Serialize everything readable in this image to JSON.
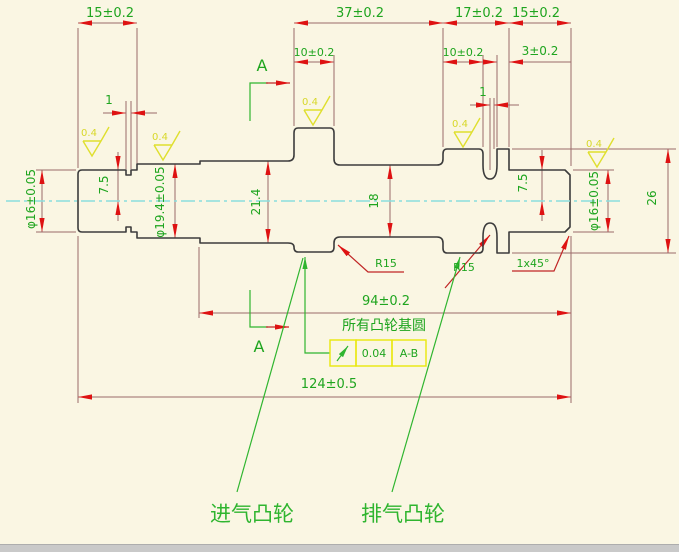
{
  "drawing_type": "camshaft engineering drawing",
  "colors": {
    "background": "#FAF6E3",
    "part_outline": "#3C3C3C",
    "centerline": "#8ADEDE",
    "dimension_line": "#9B6A6A",
    "arrow": "#DE1212",
    "dimension_text": "#1FA51F",
    "leader_line": "#C02525",
    "surface_finish_symbol": "#DFDF2E",
    "tolerance_frame_border": "#E8E80A",
    "cam_label_green": "#2FB52F"
  },
  "dimensions": {
    "top_row": [
      {
        "id": "left-end-length",
        "text": "15±0.2"
      },
      {
        "id": "intake-to-exhaust-span",
        "text": "37±0.2"
      },
      {
        "id": "exhaust-group-length",
        "text": "17±0.2"
      },
      {
        "id": "right-end-length",
        "text": "15±0.2"
      }
    ],
    "second_row": [
      {
        "id": "intake-cam-width",
        "text": "10±0.2"
      },
      {
        "id": "exhaust-cam-width",
        "text": "10±0.2"
      },
      {
        "id": "disc-width",
        "text": "3±0.2"
      }
    ],
    "groove_left": "1",
    "groove_right": "1",
    "diameters": [
      {
        "id": "left-journal-diameter",
        "text": "φ16±0.05"
      },
      {
        "id": "left-half-height",
        "text": "7.5"
      },
      {
        "id": "second-journal-diameter",
        "text": "φ19.4±0.05"
      },
      {
        "id": "base-circle-diameter",
        "text": "21.4"
      },
      {
        "id": "center-shaft-diameter",
        "text": "18"
      },
      {
        "id": "right-half-height",
        "text": "7.5"
      },
      {
        "id": "right-journal-diameter",
        "text": "φ16±0.05"
      },
      {
        "id": "cam-total-height",
        "text": "26"
      }
    ],
    "length_94": "94±0.2",
    "length_124": "124±0.5",
    "radius_left": "R15",
    "radius_right": "R15",
    "chamfer": "1x45°"
  },
  "annotations": {
    "section_label": "A",
    "note_base_circle": "所有凸轮基圆",
    "surface_roughness": "0.4",
    "tolerance_frame": {
      "symbol": "circular-runout",
      "value": "0.04",
      "datum": "A-B"
    },
    "intake_cam": "进气凸轮",
    "exhaust_cam": "排气凸轮"
  }
}
